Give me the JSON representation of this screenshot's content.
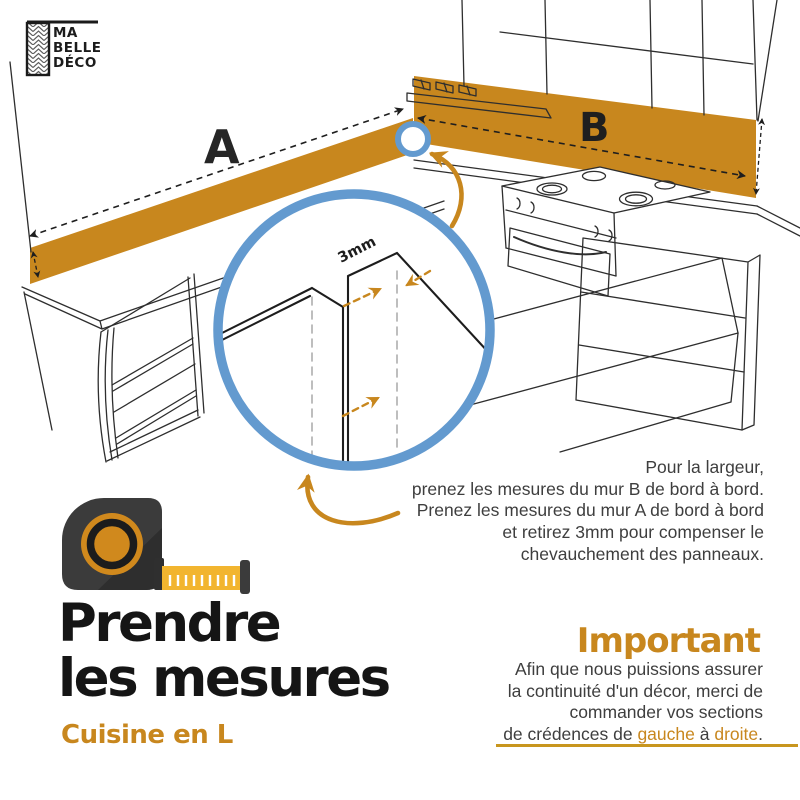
{
  "logo": {
    "line1": "MA",
    "line2": "BELLE",
    "line3": "DÉCO"
  },
  "diagram": {
    "wall_a_label": "A",
    "wall_b_label": "B",
    "overlap_label": "3mm"
  },
  "measure_note": {
    "lines": [
      "Pour la largeur,",
      "prenez les mesures du mur B de bord à bord.",
      "Prenez les mesures du mur A de bord à bord",
      "et retirez 3mm pour compenser le",
      "chevauchement des panneaux."
    ]
  },
  "title": {
    "line1": "Prendre",
    "line2": "les mesures",
    "subtitle": "Cuisine en L"
  },
  "important": {
    "heading": "Important",
    "lines": [
      "Afin que nous puissions assurer",
      "la continuité d'un décor, merci de",
      "commander vos sections"
    ],
    "last_line": {
      "part1": "de crédences de ",
      "highlight1": "gauche",
      "part2": " à ",
      "highlight2": "droite",
      "part3": "."
    }
  },
  "colors": {
    "accent_orange": "#c8871e",
    "accent_blue": "#639acf",
    "tape_yellow": "#f2b52f",
    "line_black": "#2e2e2e",
    "text_gray": "#3e3e3e"
  }
}
